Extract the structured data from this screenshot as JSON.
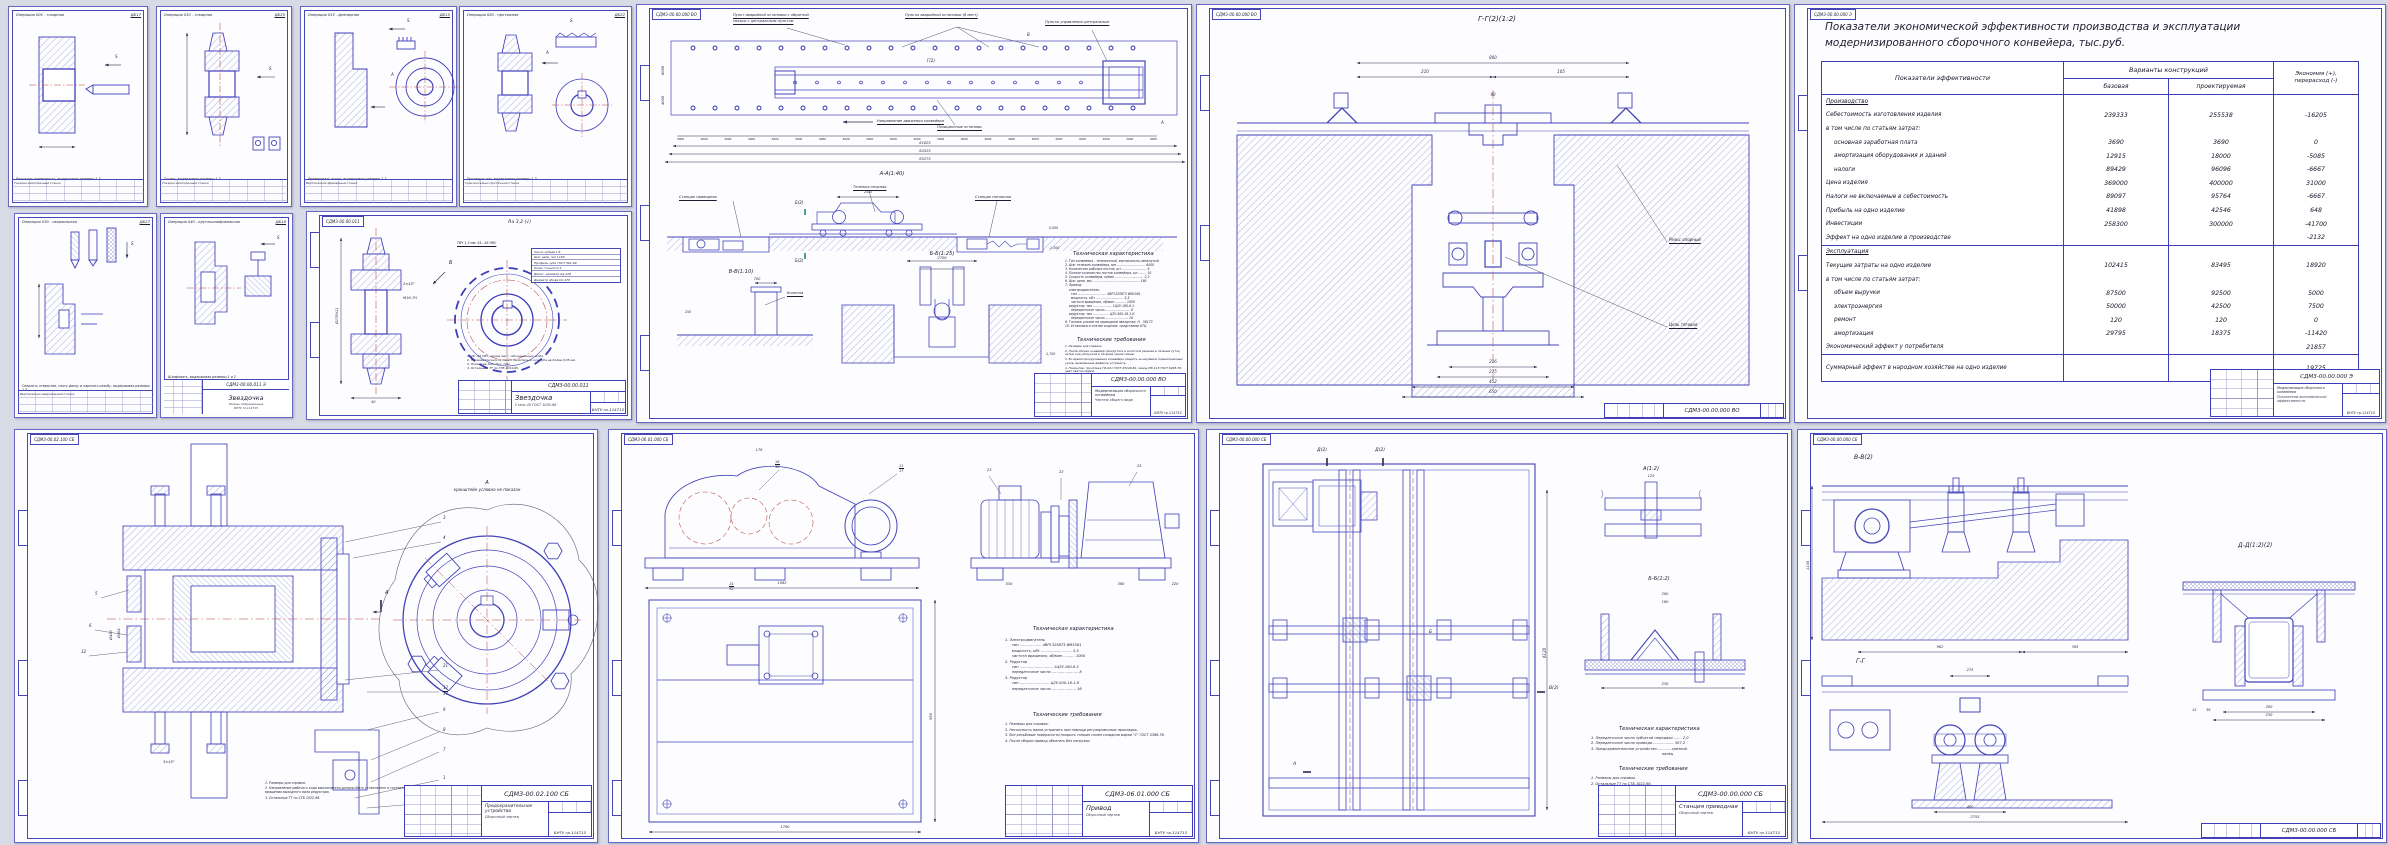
{
  "page": {
    "bg": "#d7dbe6",
    "line_blue": "#3d3dba",
    "hatch_blue": "#7a7ac9",
    "red_centerline": "#b3473d"
  },
  "cards": [
    {
      "code": "ДБ17",
      "title": "Операция 005 - токарная",
      "caption": "Расточить поверхность, выдерживая размеры 1-3",
      "machine": "Токарно-винторезный станок",
      "fixture": "Приспособление с зажимом станка"
    },
    {
      "code": "ДБ25",
      "title": "Операция 010 - токарная",
      "caption": "Точить, выдерживая размеры 1-3",
      "machine": "Токарно-винторезный станок",
      "fixture": "Приспособление с зажимом станка"
    },
    {
      "code": "ДБ15",
      "title": "Операция 015 - фрезерная",
      "caption": "Фрезеровать лыски, выдерживая размеры 1-2",
      "machine": "Вертикально-фрезерный станок",
      "fixture": "Приспособление с зажимом станка"
    },
    {
      "code": "ДБ22",
      "title": "Операция 020 - протяжная",
      "caption": "Протянуть паз, выдерживая размеры 1-3",
      "machine": "Горизонтально-протяжной станок",
      "fixture": "Приспособление с зажимом станка"
    },
    {
      "code": "ДБ27",
      "title": "Операция 030 - сверлильная",
      "caption": "Сверлить отверстие, снять фаску и нарезать резьбу, выдерживая размеры 1-3",
      "machine": "Вертикально-сверлильный станок",
      "fixture": "Приспособление с зажимом станка"
    },
    {
      "code": "ДБ18",
      "title": "Операция 040 - круглошлифовальная",
      "caption": "Шлифовать, выдерживая размеры 1 и 2",
      "machine": "Круглошлифовальный станок",
      "fixture": "Приспособление с зажимом станка"
    }
  ],
  "card_stamp": {
    "code": "СДМ3-00.00.011 Э",
    "title": "Звездочка",
    "subtitle": "Эскизы операционные",
    "org": "БНТУ гр.114715"
  },
  "sprocket": {
    "corner_code": "СДМ3-00.00.011",
    "roughness": "Ra 3,2 (√)",
    "view_b": "Б",
    "surface_note": "ТВЧ 1,3 мм; 45...48 HRC",
    "param_lines": [
      "Число зубьев        z      8",
      "Шаг цепи, мм       t    160",
      "Профиль зуба  ГОСТ 591-69",
      "Класс точности          3",
      "Делит. диаметр   dд   418",
      "Диаметр обода   Dо   470"
    ],
    "notes": [
      "1. 28...32 HRC, кроме мест, обозначенных особо.",
      "2. Несимметричность паза относительно оси зуба не более 0,05 мм.",
      "3. Покрытие Хим. Окс. прм.",
      "4. Остальные ТТ по СТБ 1014-95."
    ],
    "dims": {
      "d176": "Ø176h11",
      "d40": "40",
      "d90": "90",
      "m16": "М16-7Н",
      "f": "2×45°"
    },
    "stamp": {
      "code": "СДМ3-00.00.011",
      "title": "Звездочка",
      "doc": "Сталь 45 ГОСТ 1050-88",
      "org": "БНТУ гр.114715"
    }
  },
  "conveyor": {
    "corner_code": "СДМ3-00.00.000 ВО",
    "labels": {
      "l1": "Пульт аварийной остановки с обратной",
      "l1b": "связью с центральным пультом",
      "l2": "Пульты аварийной остановки (6 мест)",
      "l3": "Пульты управления центральные",
      "dir": "Направление движения конвейера",
      "stops": "Позиционные остановы",
      "drive": "Станция приводная",
      "trolley": "Тележка опорная",
      "tension": "Станция натяжная",
      "column": "Колонна",
      "chain": "160 - шаг цепи"
    },
    "sections": {
      "aa": "А-А(1:40)",
      "bb": "Б-Б(1:25)",
      "vv": "В-В(1:10)",
      "b2": "Б(2)",
      "g2": "Г(2)",
      "v": "В",
      "a": "А"
    },
    "step_dims": [
      "3000",
      "3000",
      "3000",
      "3000",
      "3000",
      "3000",
      "3000",
      "3000",
      "3000",
      "3000",
      "3000",
      "3000",
      "3000",
      "3000",
      "3000",
      "3000",
      "3000",
      "3000",
      "3000",
      "3000",
      "3000"
    ],
    "dims": {
      "o1": "61825",
      "o2": "64325",
      "o3": "65275",
      "car": "2445",
      "d1": "12620",
      "d2": "10420",
      "d3": "10000",
      "v6000": "6000",
      "v4000": "4000",
      "e0": "0,000",
      "e1": "-1,500",
      "e2": "-1,700",
      "b1": "2700",
      "b2": "1500",
      "v1": "700",
      "v2": "500",
      "v3": "250"
    },
    "tech_char_title": "Техническая характеристика",
    "tech_char": [
      "1. Тип конвейера - тележечный, вертикально-замкнутый",
      "2. Шаг тележек конвейера, мм ............................. 6000",
      "3. Количество рабочих постов, шт ......................... 9",
      "4. Полное количество постов конвейера, шт ........ 10",
      "5. Скорость конвейера, м/мин ............................. 2,2",
      "6. Шаг цепи, мм ................................................ 160",
      "7. Привод:",
      "    электродвигатель:",
      "      тип ............................. 4ВР132S6Т3 ИМ1081",
      "      мощность, кВт ............................ 5,5",
      "      частота вращения, об/мин ........... 1000",
      "    редуктор: тип ................... 1Ц2У-160-8-1",
      "      передаточное число ......................... 8",
      "    редуктор: тип ................ Ц2У-500-16-1-К",
      "      передаточное число ....................... 16",
      "9. Тяговое усилие на приводной звездочке, Н   36173",
      "10. Установка и снятие изделия  средствами ОТЦ"
    ],
    "tech_req_title": "Технические требования",
    "tech_req": [
      "1. Размеры для справок.",
      "2. После сборки конвейер прокрутить в холостом режиме в течение суток, затем под нагрузкой в течение одной смены.",
      "3. Во время прокручивания конвейера следить за нагревом подшипниковых узлов, выявленные дефекты устранить.",
      "4. Покрытие: грунтовка ГФ-021 ГОСТ 25129-82, эмаль ПФ-115 ГОСТ 6465-76, цвет светло-серый.",
      "5. Остальные ТТ по СТБ 1022-96."
    ],
    "stamp": {
      "code": "СДМ3-00.00.000 ВО",
      "title": "Модернизация сборочного конвейера",
      "doc": "Чертеж общего вида",
      "org": "БНТУ гр.114715"
    }
  },
  "gg": {
    "corner_code": "СДМ3-00.00.000 ВО",
    "title": "Г-Г(2)(1:2)",
    "labels": {
      "rail": "Рельс опорный",
      "chain": "Цепь тяговая"
    },
    "dims": {
      "d800": "800",
      "d210": "210",
      "d105": "105",
      "d90": "90",
      "d216": "216",
      "d275": "275",
      "d452": "452",
      "d650": "650"
    },
    "stamp_code": "СДМ3-00.00.000 ВО"
  },
  "econ": {
    "corner_code": "СДМ3-00.00.000 Э",
    "title1": "Показатели экономической эффективности производства и эксплуатации",
    "title2": "модернизированного сборочного конвейера, тыс.руб.",
    "col_label": "Показатели эффективности",
    "col_variants": "Варианты конструкций",
    "col_base": "базовая",
    "col_proj": "проектируемая",
    "col_econ1": "Экономия (+),",
    "col_econ2": "перерасход (-)",
    "rows": [
      {
        "label": "Производство",
        "section": true
      },
      {
        "label": "Себестоимость изготовления изделия",
        "base": "239333",
        "proj": "255538",
        "econ": "-16205"
      },
      {
        "label": "в том числе по статьям затрат:"
      },
      {
        "label": "основная заработная плата",
        "ind": true,
        "base": "3690",
        "proj": "3690",
        "econ": "0"
      },
      {
        "label": "амортизация оборудования и зданий",
        "ind": true,
        "base": "12915",
        "proj": "18000",
        "econ": "-5085"
      },
      {
        "label": "налоги",
        "ind": true,
        "base": "89429",
        "proj": "96096",
        "econ": "-6667"
      },
      {
        "label": "Цена изделия",
        "base": "369000",
        "proj": "400000",
        "econ": "31000"
      },
      {
        "label": "Налоги не включаемые в себестоимость",
        "base": "89097",
        "proj": "95764",
        "econ": "-6667"
      },
      {
        "label": "Прибыль на одно изделие",
        "base": "41898",
        "proj": "42546",
        "econ": "648"
      },
      {
        "label": "Инвестиции",
        "base": "258300",
        "proj": "300000",
        "econ": "-41700"
      },
      {
        "label": "Эффект на одно изделие в производстве",
        "econ": "-2132"
      },
      {
        "label": "Эксплуатация",
        "section": true,
        "sep": true
      },
      {
        "label": "Текущие затраты на одно изделие",
        "base": "102415",
        "proj": "83495",
        "econ": "18920"
      },
      {
        "label": "в том числе по статьям затрат:"
      },
      {
        "label": "объем выручки",
        "ind": true,
        "base": "87500",
        "proj": "92500",
        "econ": "5000"
      },
      {
        "label": "электроэнергия",
        "ind": true,
        "base": "50000",
        "proj": "42500",
        "econ": "7500"
      },
      {
        "label": "ремонт",
        "ind": true,
        "base": "120",
        "proj": "120",
        "econ": "0"
      },
      {
        "label": "амортизация",
        "ind": true,
        "base": "29795",
        "proj": "18375",
        "econ": "-11420"
      },
      {
        "label": "Экономический эффект у потребителя",
        "econ": "21857"
      },
      {
        "label": "Суммарный эффект в народном хозяйстве на одно изделие",
        "sep": true,
        "tall": true,
        "econ": "19725"
      }
    ],
    "stamp": {
      "code": "СДМ3-00.00.000 Э",
      "title": "Модернизация сборочного конвейера",
      "doc": "Показатели экономической эффективности",
      "org": "БНТУ гр.114715"
    }
  },
  "safety": {
    "corner_code": "СДМ3-00.02.100 СБ",
    "view_label": "А",
    "view_note": "кронштейн условно не показан",
    "marker_a": "А",
    "callouts": [
      "3",
      "4",
      "5",
      "6",
      "21",
      "12",
      "17",
      "9",
      "8",
      "7",
      "1",
      "22"
    ],
    "dims": {
      "d420": "Ø420",
      "d404": "Ø404",
      "f": "3×45°"
    },
    "notes": [
      "1. Размеры для справок.",
      "2. Направление рабочего хода выключателя должно быть установлено в соответствии с направлением вращения выходного вала редуктора.",
      "3. Остальные ТТ по СТБ 1022-96."
    ],
    "stamp": {
      "code": "СДМ3-00.02.100 СБ",
      "title": "Предохранительное устройство",
      "doc": "Сборочный чертеж",
      "org": "БНТУ гр.114715"
    }
  },
  "drive": {
    "corner_code": "СДМ3-06.01.000 СБ",
    "callouts": {
      "c1": "16",
      "c1b": "38",
      "c2": "11",
      "c2b": "17",
      "c3": "15",
      "c3b": "32",
      "c4": "23",
      "c5": "22",
      "c6": "25",
      "c7": "96",
      "c8": "8",
      "c9": "1",
      "c10": "2"
    },
    "dims": {
      "d1780": "1780",
      "d1062": "1062",
      "d550": "550",
      "d178": "178",
      "d530": "530",
      "d630": "630",
      "d465": "465",
      "d104": "104,5",
      "d360": "360",
      "d220": "220"
    },
    "tech_char_title": "Техническая характеристика",
    "tech_char": [
      "1. Электродвигатель",
      "      тип ................... 4ВР132S6Т3 ИМ1081",
      "      мощность, кВт ........................... 5,5",
      "      частота вращения, об/мин .......... 1000",
      "2. Редуктор",
      "      тип ............................. 1Ц2У-160-8-1",
      "      передаточное число ....................... 8",
      "3. Редуктор",
      "      тип .......................... Ц2У-500-16-1-К",
      "      передаточное число ..................... 16"
    ],
    "tech_req_title": "Технические требования",
    "tech_req": [
      "1. Размеры для справок.",
      "2. Несоосность валов устранить при помощи регулировочных прокладок.",
      "3. Все резьбовые поверхности покрыть тонким слоем солидола марки \"С\" ГОСТ 4366-76.",
      "4. После сборки привод обкатать без нагрузки."
    ],
    "stamp": {
      "code": "СДМ3-06.01.000 СБ",
      "title": "Привод",
      "doc": "Сборочный чертеж",
      "org": "БНТУ гр.114715"
    }
  },
  "station": {
    "corner_code": "СДМ3-00.00.000 СБ",
    "detail_a": "А(1:2)",
    "detail_bb": "Б-Б(1:2)",
    "markers": {
      "d1": "Д(2)",
      "d2": "Д(2)",
      "b": "Б",
      "v": "В(2)",
      "a": "А"
    },
    "callouts": [
      "1",
      "2",
      "5",
      "6",
      "7"
    ],
    "dims": {
      "d6120": "6120",
      "d230": "230",
      "d200": "200",
      "d160": "160",
      "d125": "125",
      "d52": "52",
      "d30": "30",
      "d40": "40"
    },
    "tech_char_title": "Техническая характеристика",
    "tech_char": [
      "1. Передаточное число зубчатой передачи ....... 2,0",
      "2. Передаточное число привода .................. 307,2",
      "3. Предохранительное устройство ........... срезной",
      "                                                              палец"
    ],
    "tech_req_title": "Технические требования",
    "tech_req": [
      "1. Размеры для справок.",
      "2. Остальные ТТ по СТБ 1022-96."
    ],
    "stamp": {
      "code": "СДМ3-00.00.000 СБ",
      "title": "Станция приводная",
      "doc": "Сборочный чертеж",
      "org": "БНТУ гр.114715"
    }
  },
  "sections8": {
    "corner_code": "СДМ3-00.00.000 СБ",
    "label_vv": "В-В(2)",
    "label_dd": "Д-Д(1:2)(2)",
    "label_gg": "Г-Г",
    "dims": {
      "d962": "962",
      "d395": "395",
      "d1130": "1130",
      "d275": "275",
      "d2755": "2755",
      "d200": "200",
      "d230": "230",
      "d400": "400",
      "d36": "36",
      "d15": "15"
    },
    "stamp_code": "СДМ3-00.00.000 СБ"
  }
}
